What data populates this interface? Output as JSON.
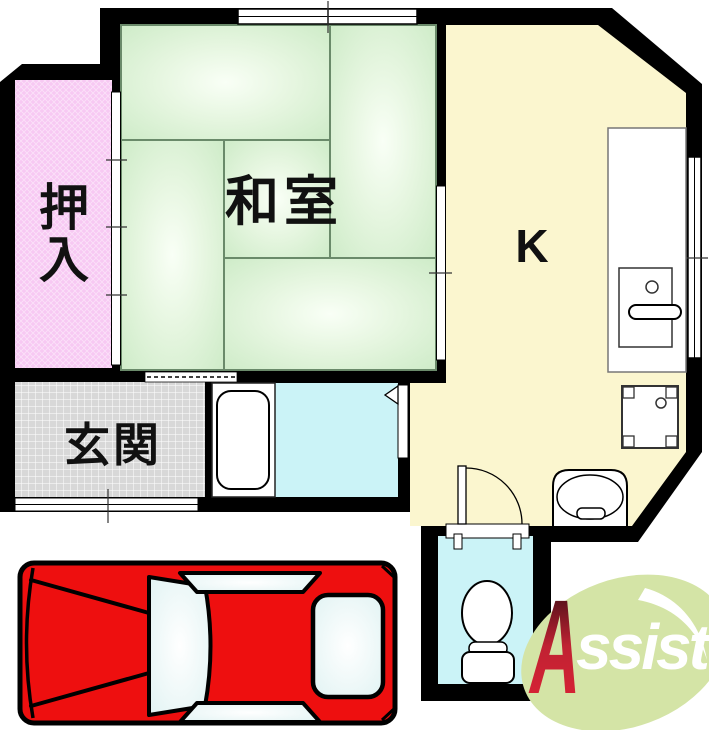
{
  "floorplan": {
    "rooms": {
      "washitsu": {
        "label": "和室"
      },
      "closet": {
        "label": "押入",
        "char_top": "押",
        "char_bottom": "入"
      },
      "genkan": {
        "label": "玄関"
      },
      "kitchen": {
        "label": "K"
      },
      "bathroom": {
        "fixture": "bathtub"
      },
      "toilet_room": {
        "fixture": "toilet"
      }
    },
    "icons": [
      "bathtub-icon",
      "toilet-icon",
      "kitchen-counter-icon",
      "kitchen-sink-icon",
      "washing-machine-pan-icon",
      "wash-basin-icon",
      "entrance-door-icon",
      "sliding-door-icon",
      "window-icon",
      "door-swing-icon",
      "car-top-view-icon",
      "leaf-icon"
    ]
  },
  "logo": {
    "brand": "Assist",
    "letter_a": "A",
    "letters_rest": "ssist"
  },
  "colors": {
    "wall": "#000000",
    "tatami_center": "#f9fff6",
    "tatami_mid": "#e6f6e0",
    "tatami_edge": "#cdebc7",
    "tatami_line": "#6a8a6a",
    "closet_pink": "#f7c9f3",
    "genkan_gray": "#d8d8d8",
    "kitchen_yellow": "#fbf6cf",
    "water_cyan": "#cbf3f7",
    "car_red": "#ee0f0f",
    "car_window": "#dff2f2",
    "leaf_green": "#d4e4a6",
    "logo_red": "#c02233",
    "label_black": "#111111"
  }
}
